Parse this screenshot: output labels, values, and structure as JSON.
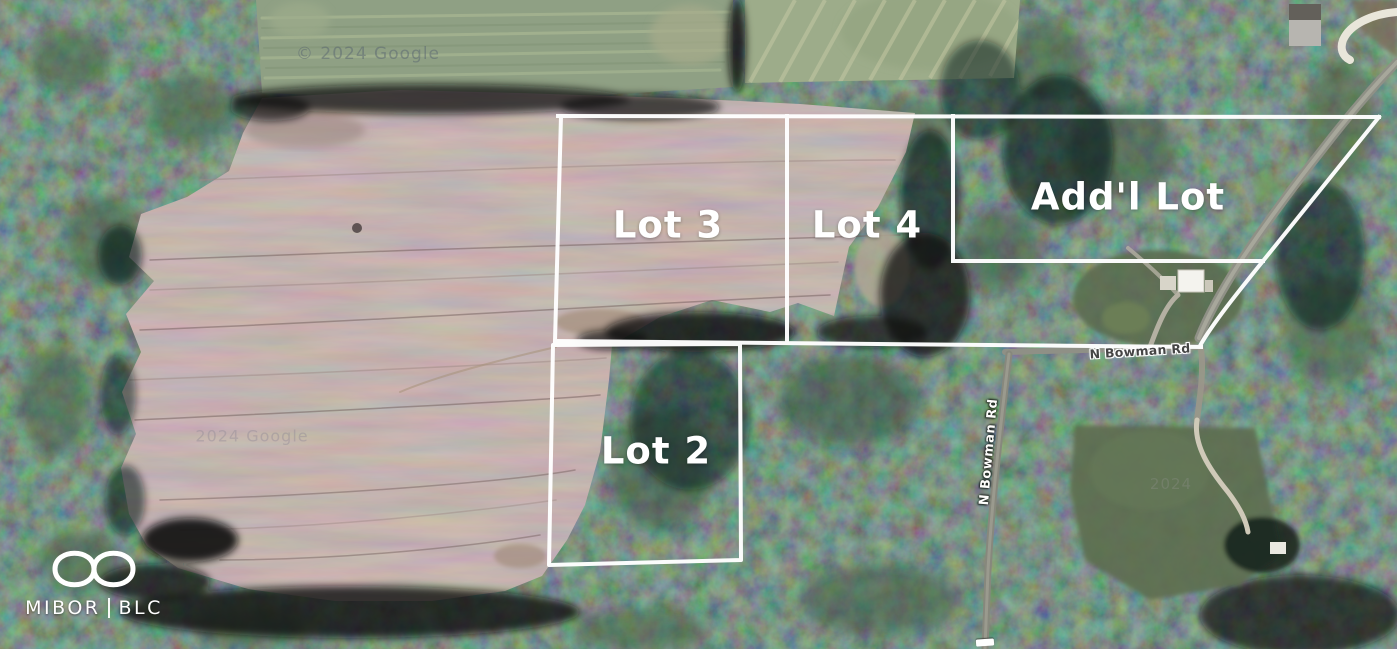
{
  "map": {
    "description": "Aerial satellite photo of wooded acreage with plowed field and white lot outline overlays",
    "lots": [
      {
        "id": "lot-3",
        "label": "Lot 3"
      },
      {
        "id": "lot-4",
        "label": "Lot 4"
      },
      {
        "id": "addl-lot",
        "label": "Add'l Lot"
      },
      {
        "id": "lot-2",
        "label": "Lot 2"
      }
    ],
    "roads": [
      {
        "id": "n-bowman-rd-east-west",
        "label": "N Bowman Rd"
      },
      {
        "id": "n-bowman-rd-north-south",
        "label": "N Bowman Rd"
      }
    ],
    "watermarks": [
      {
        "id": "top-watermark",
        "text": "© 2024 Google"
      },
      {
        "id": "field-watermark",
        "text": "2024 Google"
      },
      {
        "id": "clearing-watermark",
        "text": "2024"
      }
    ],
    "logo": {
      "left": "MIBOR",
      "right": "BLC",
      "symbol": "infinity-icon"
    },
    "colors": {
      "boundary_line": "#ffffff",
      "lot_label_text": "#ffffff",
      "field_brown": "#7e6b69",
      "forest_green": "#243029",
      "pale_field_green": "#8fa084",
      "road_gray": "#8f9086",
      "road_label_dark": "#454545",
      "logo_white": "#ffffff"
    }
  }
}
